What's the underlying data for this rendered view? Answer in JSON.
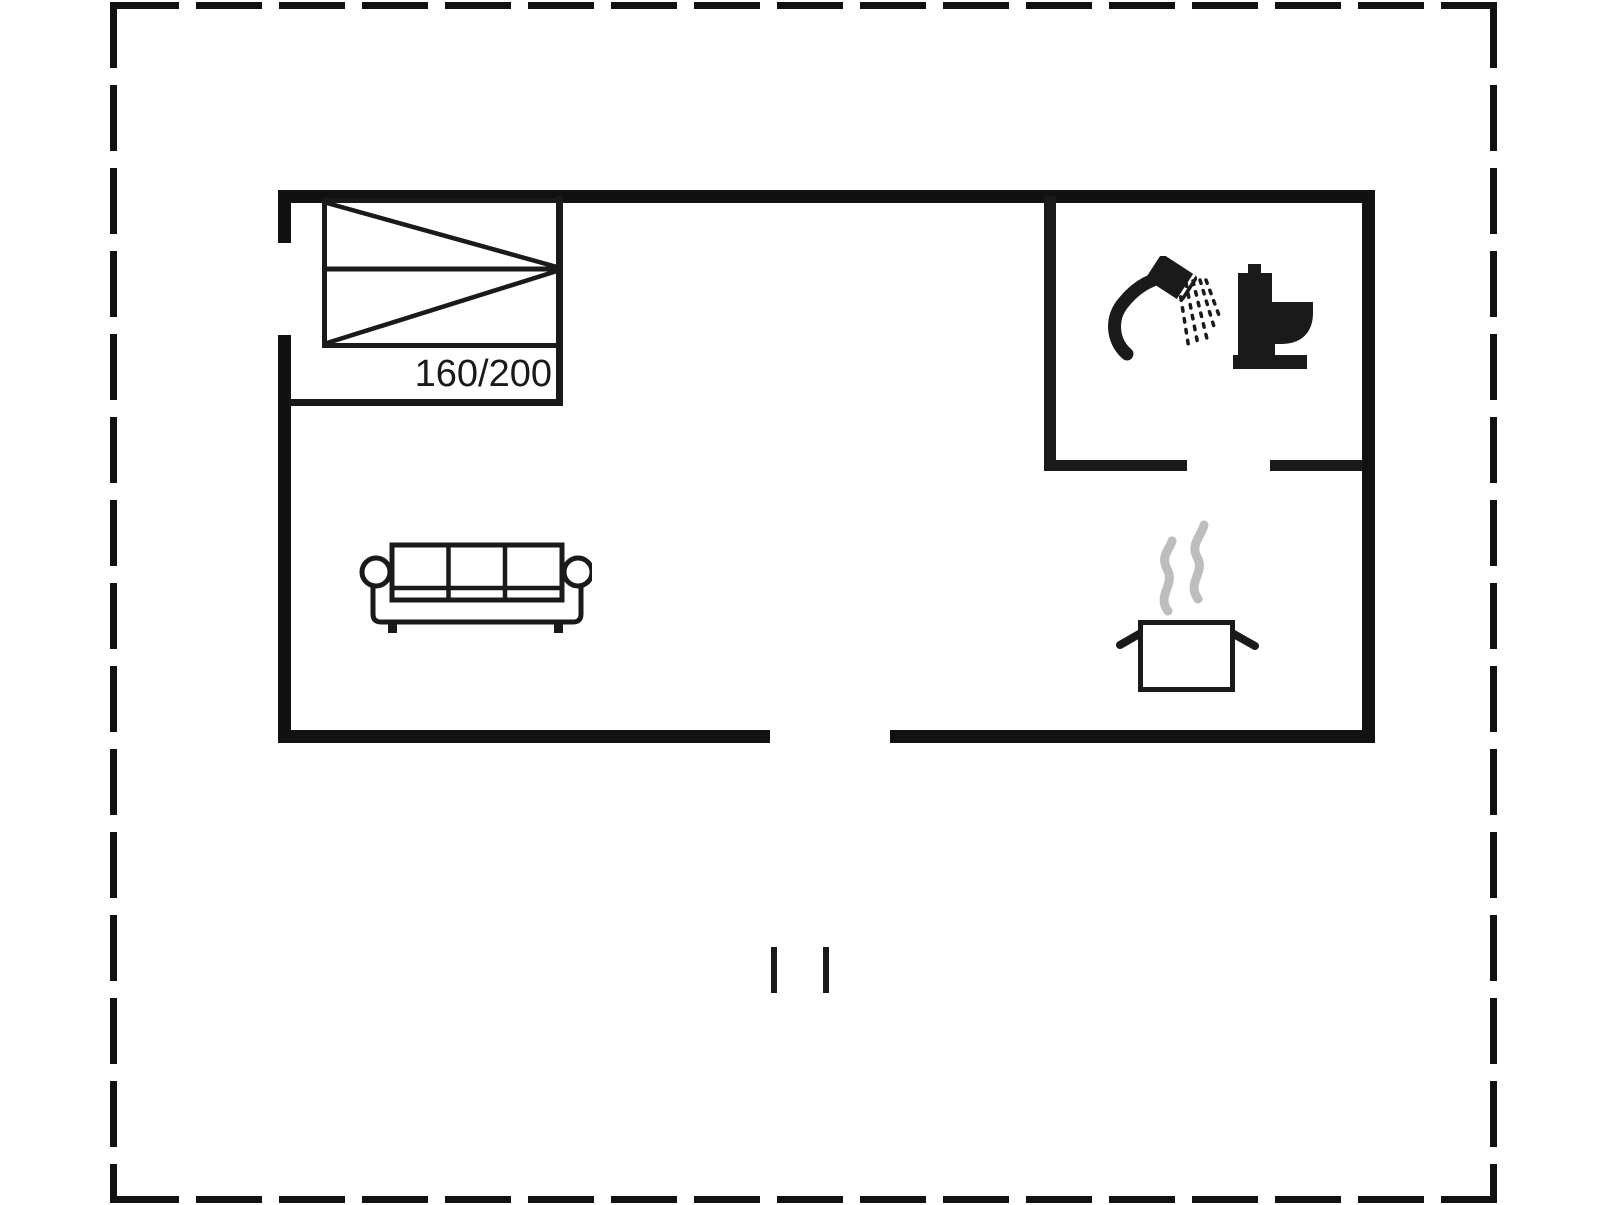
{
  "floorplan": {
    "bed": {
      "size_label": "160/200"
    },
    "icons": {
      "bed": "double-bed-icon",
      "sofa": "sofa-icon",
      "shower": "shower-head-icon",
      "toilet": "toilet-icon",
      "cooking_pot": "steaming-pot-icon"
    },
    "colors": {
      "wall": "#111111",
      "line": "#1a1a1a",
      "steam": "#bdbdbd",
      "background": "#ffffff"
    }
  }
}
